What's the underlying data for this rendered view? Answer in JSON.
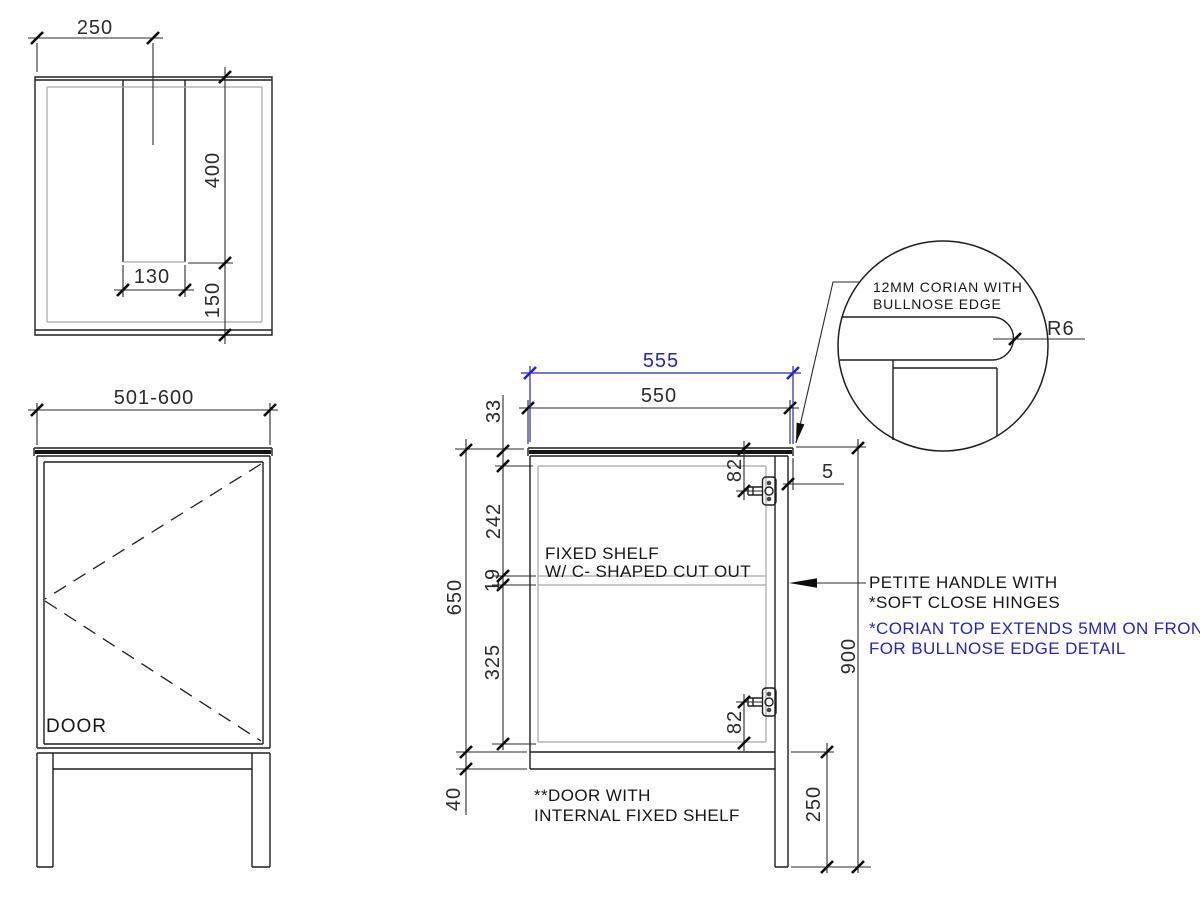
{
  "colors": {
    "line": "#1e1e1e",
    "secondary_gray": "#a8a8a8",
    "accent_blue": "#2323cc"
  },
  "top_view": {
    "dim_width": "250",
    "dim_slot_depth": "400",
    "dim_slot_width": "130",
    "dim_back_offset": "150"
  },
  "front_view": {
    "dim_width": "501-600",
    "door_label": "DOOR"
  },
  "side_view": {
    "dim_corian_width": "555",
    "dim_carcass_depth": "550",
    "dim_top_gap": "33",
    "dim_above_shelf": "242",
    "dim_shelf": "19",
    "dim_below_shelf": "325",
    "dim_carcass_height": "650",
    "dim_hinge_top": "82",
    "dim_hinge_bottom": "82",
    "dim_overhang": "5",
    "dim_rail": "40",
    "dim_leg": "250",
    "dim_total_height": "900",
    "note_shelf_line1": "FIXED SHELF",
    "note_shelf_line2": "W/ C- SHAPED CUT OUT",
    "note_door_line1": "**DOOR WITH",
    "note_door_line2": "INTERNAL FIXED SHELF",
    "note_handle_line1": "PETITE HANDLE WITH",
    "note_handle_line2": "*SOFT CLOSE HINGES",
    "note_corian_line1": "*CORIAN TOP EXTENDS 5MM ON FRONT",
    "note_corian_line2": "FOR BULLNOSE EDGE DETAIL"
  },
  "detail_view": {
    "note_line1": "12MM CORIAN WITH",
    "note_line2": "BULLNOSE EDGE",
    "dim_radius": "R6"
  }
}
